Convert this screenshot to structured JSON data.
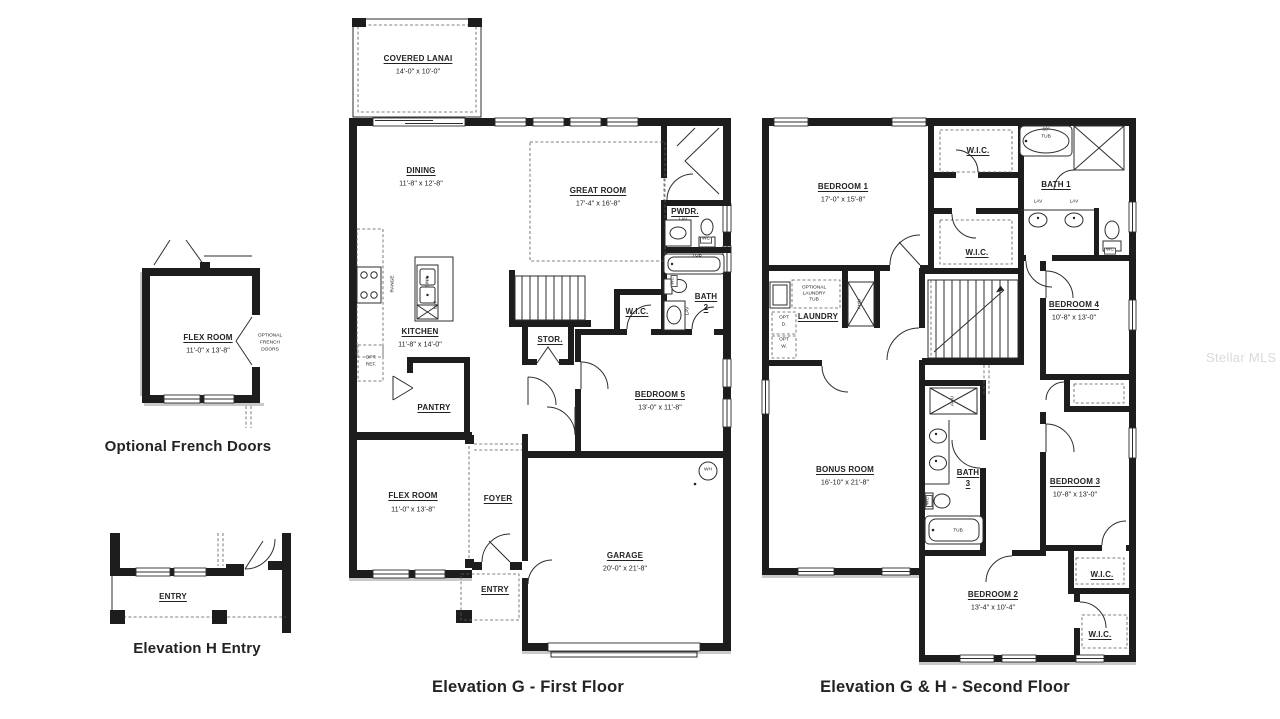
{
  "watermark": "Stellar MLS",
  "captions": {
    "french": "Optional French Doors",
    "entry_h": "Elevation H Entry",
    "first": "Elevation G - First Floor",
    "second": "Elevation G & H - Second Floor"
  },
  "ff": {
    "lanai": "COVERED LANAI",
    "lanai_d": "14'-0\" x 10'-0\"",
    "dining": "DINING",
    "dining_d": "11'-8\" x 12'-8\"",
    "great": "GREAT ROOM",
    "great_d": "17'-4\" x 16'-8\"",
    "pwdr": "PWDR.",
    "kitchen": "KITCHEN",
    "kitchen_d": "11'-8\" x 14'-0\"",
    "stor": "STOR.",
    "wic": "W.I.C.",
    "bath2": "BATH",
    "bath2_n": "2",
    "bed5": "BEDROOM 5",
    "bed5_d": "13'-0\" x 11'-8\"",
    "pantry": "PANTRY",
    "flex": "FLEX ROOM",
    "flex_d": "11'-0\" x 13'-8\"",
    "foyer": "FOYER",
    "entry": "ENTRY",
    "garage": "GARAGE",
    "garage_d": "20'-0\" x 21'-8\""
  },
  "sf": {
    "bed1": "BEDROOM 1",
    "bed1_d": "17'-0\" x 15'-8\"",
    "wic": "W.I.C.",
    "bath1": "BATH 1",
    "bed4": "BEDROOM 4",
    "bed4_d": "10'-8\" x 13'-0\"",
    "laundry": "LAUNDRY",
    "bonus": "BONUS ROOM",
    "bonus_d": "16'-10\" x 21'-8\"",
    "bath3": "BATH",
    "bath3_n": "3",
    "bed3": "BEDROOM 3",
    "bed3_d": "10'-8\" x 13'-0\"",
    "bed2": "BEDROOM 2",
    "bed2_d": "13'-4\" x 10'-4\""
  },
  "inset": {
    "flex": "FLEX ROOM",
    "flex_d": "11'-0\" x 13'-8\"",
    "entry": "ENTRY"
  },
  "fix": {
    "lav": "LAV",
    "wc": "WC",
    "tub": "TUB",
    "tub60": "60\"",
    "ahu": "AHU",
    "wh": "WH",
    "range": "RANGE",
    "sink": "SINK",
    "dw": "DW",
    "optref1": "OPT.",
    "optref2": "REF.",
    "optd1": "OPT",
    "optd2": "D.",
    "optw1": "OPT",
    "optw2": "W.",
    "olt1": "OPTIONAL",
    "olt2": "LAUNDRY",
    "olt3": "TUB",
    "ofd1": "OPTIONAL",
    "ofd2": "FRENCH",
    "ofd3": "DOORS"
  }
}
